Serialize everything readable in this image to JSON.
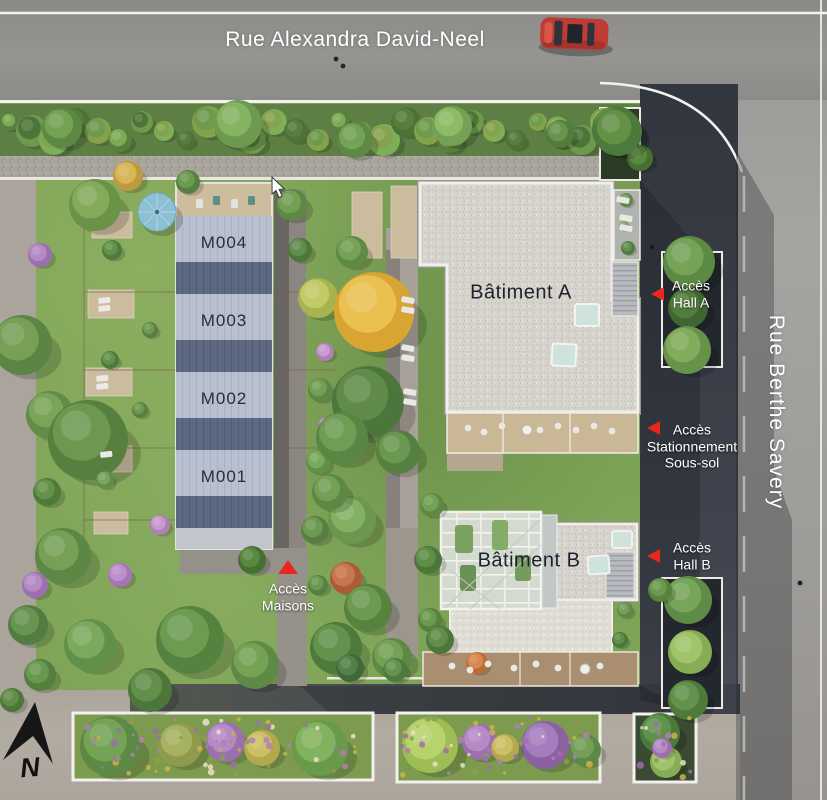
{
  "streets": {
    "top": "Rue Alexandra David-Neel",
    "right": "Rue Berthe Savery"
  },
  "buildings": {
    "a": "Bâtiment A",
    "b": "Bâtiment B",
    "maisons": [
      "M004",
      "M003",
      "M002",
      "M001"
    ]
  },
  "access": {
    "hall_a": {
      "line1": "Accès",
      "line2": "Hall A"
    },
    "parking": {
      "line1": "Accès",
      "line2": "Stationnement",
      "line3": "Sous-sol"
    },
    "hall_b": {
      "line1": "Accès",
      "line2": "Hall B"
    },
    "maisons": {
      "line1": "Accès",
      "line2": "Maisons"
    }
  },
  "compass": {
    "north": "N"
  },
  "colors": {
    "marker_red": "#e8281e",
    "street_text": "#ffffff",
    "building_text": "#1d232e",
    "light_roof": "#b8c0cf",
    "dark_roof": "#5d6883",
    "gravel_roof": "#d7d3cd"
  }
}
